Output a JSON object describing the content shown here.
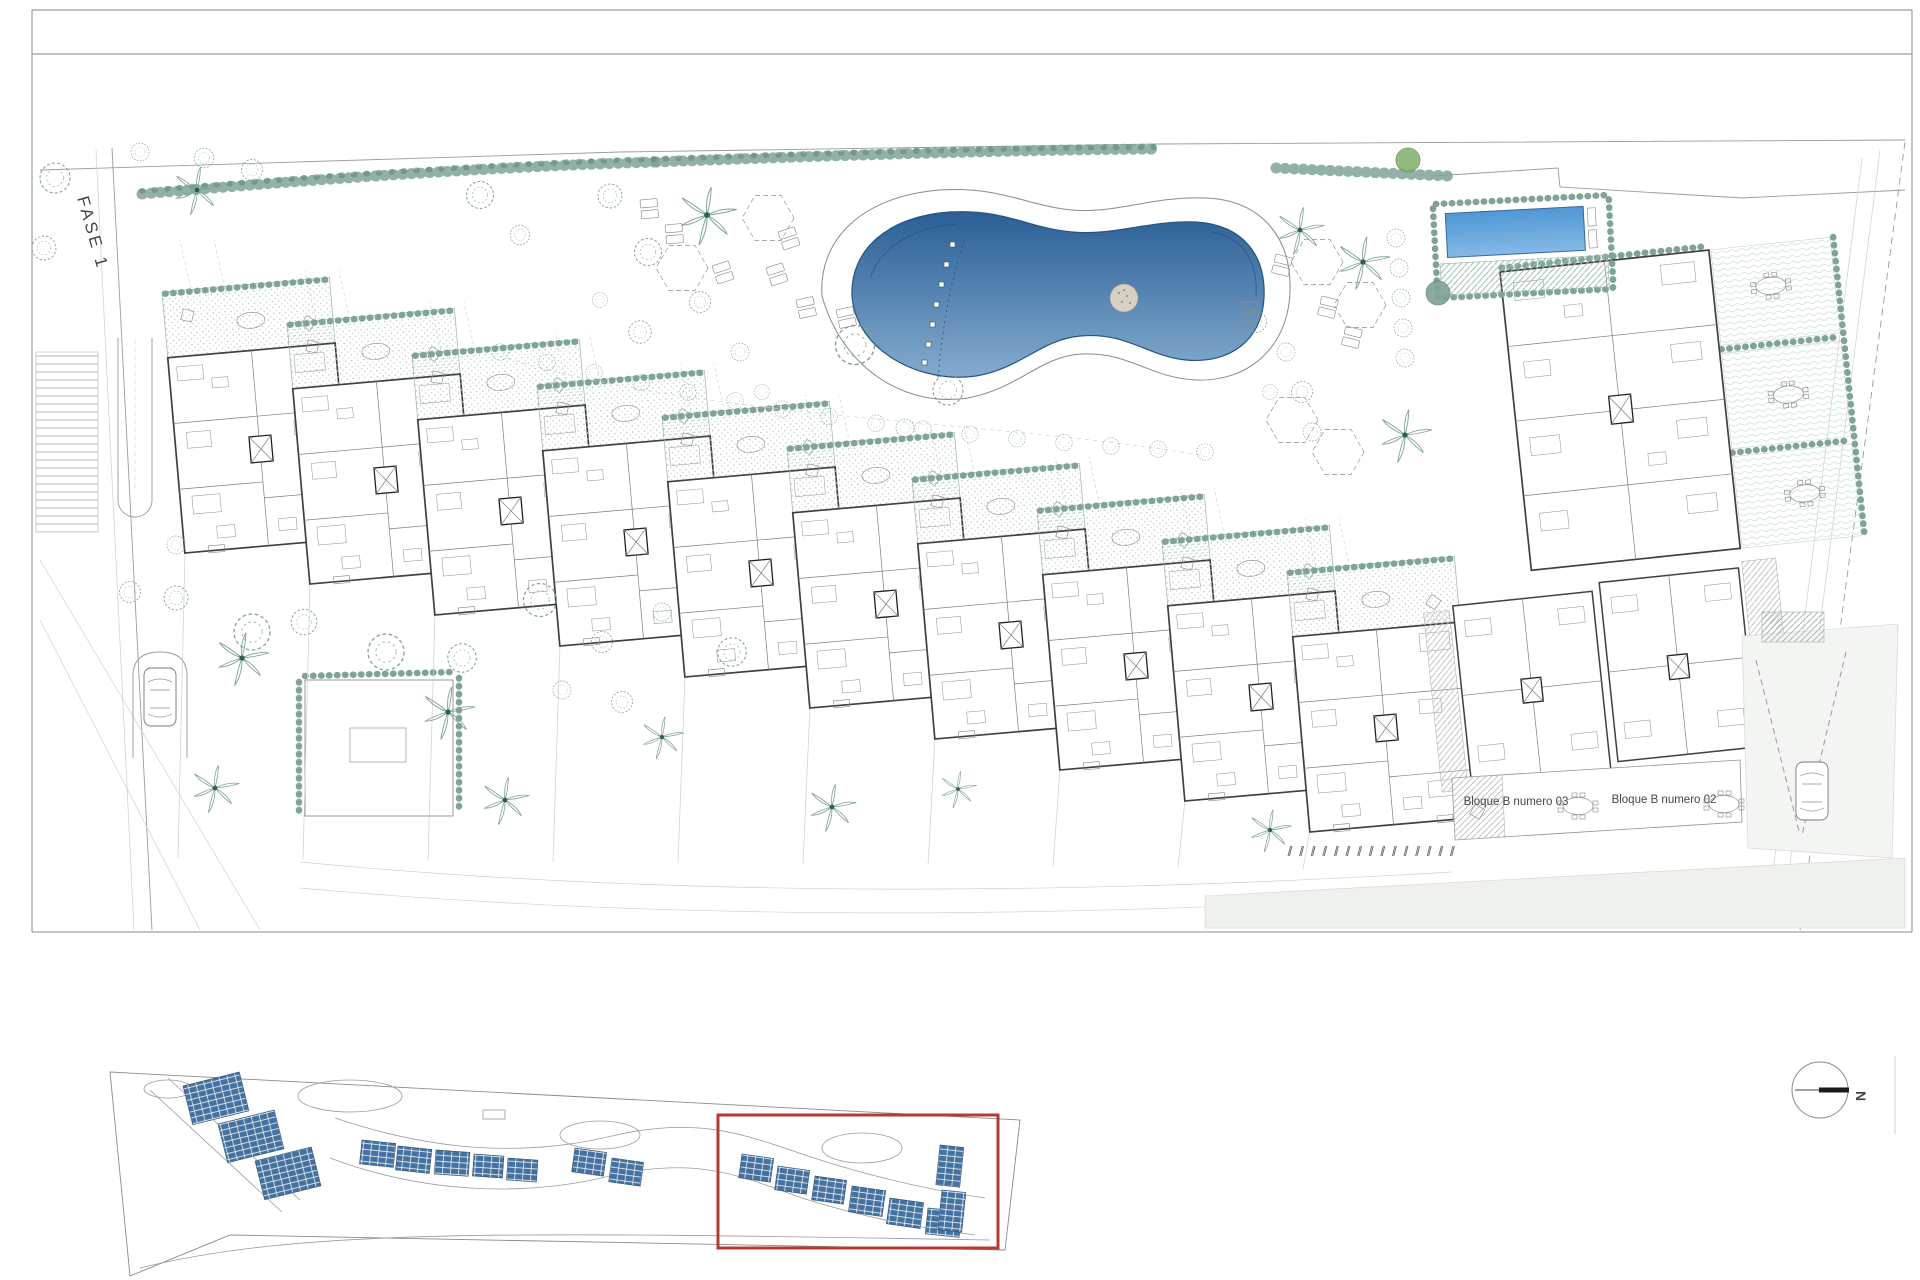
{
  "sheet": {
    "phase_label": "FASE 1",
    "north_label": "N",
    "block_labels": [
      {
        "id": "block-03",
        "label": "Bloque B numero 03"
      },
      {
        "id": "block-02",
        "label": "Bloque B numero 02"
      }
    ],
    "counts": {
      "cascade_apartment_blocks": 10,
      "parking_space_marks": 15,
      "key_plan_roof_blocks": 18
    },
    "key_plan": {
      "highlight_present": true
    }
  },
  "colors": {
    "pool_deep": "#2a5f96",
    "pool_light": "#83abce",
    "kids_pool_top": "#4f97d4",
    "kids_pool_bottom": "#85b9e6",
    "vegetation": "#7fa396",
    "vegetation_dark": "#2f5d4e",
    "green_tree": "#7fb069",
    "roof_blue": "#44719f",
    "highlight_red": "#b23b34",
    "wall": "#3f3f3f",
    "line_light": "#9a9a9a",
    "paving": "#eef1ec",
    "hatch_gray": "#c2c2c2"
  }
}
